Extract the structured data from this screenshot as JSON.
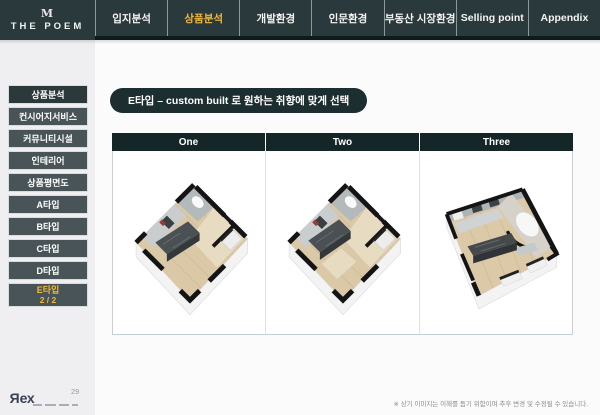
{
  "header": {
    "logo": {
      "icon": "M",
      "title": "THE POEM"
    },
    "tabs": [
      {
        "label": "입지분석",
        "active": false
      },
      {
        "label": "상품분석",
        "active": true
      },
      {
        "label": "개발환경",
        "active": false
      },
      {
        "label": "인문환경",
        "active": false
      },
      {
        "label": "부동산 시장환경",
        "active": false
      },
      {
        "label": "Selling point",
        "active": false
      },
      {
        "label": "Appendix",
        "active": false
      }
    ]
  },
  "sidebar": {
    "items": [
      {
        "label": "상품분석"
      },
      {
        "label": "컨시어지서비스"
      },
      {
        "label": "커뮤니티시설"
      },
      {
        "label": "인테리어"
      },
      {
        "label": "상품평면도"
      },
      {
        "label": "A타입"
      },
      {
        "label": "B타입"
      },
      {
        "label": "C타입"
      },
      {
        "label": "D타입"
      },
      {
        "label": "E타입",
        "sublabel": "2 / 2"
      }
    ]
  },
  "main": {
    "title": "E타입 – custom built 로 원하는 취향에 맞게 선택",
    "columns": [
      {
        "label": "One"
      },
      {
        "label": "Two"
      },
      {
        "label": "Three"
      }
    ]
  },
  "footer": {
    "page_number": "29",
    "brand": "Rex",
    "disclaimer": "※ 상기 이미지는 이해를 돕기 위함이며 추후 변경 및 수정될 수 있습니다."
  },
  "colors": {
    "header_bg": "#2a393b",
    "header_bottom_strip": "#0e1a1b",
    "accent_yellow": "#f0b83d",
    "sidebar_btn": "#485457",
    "sidebar_btn_active": "#2b393b",
    "title_pill": "#1d2e30",
    "column_header": "#142628",
    "table_border": "#c5d0d4",
    "page_bg": "#efeef0",
    "wood_floor": "#dac8a7"
  }
}
